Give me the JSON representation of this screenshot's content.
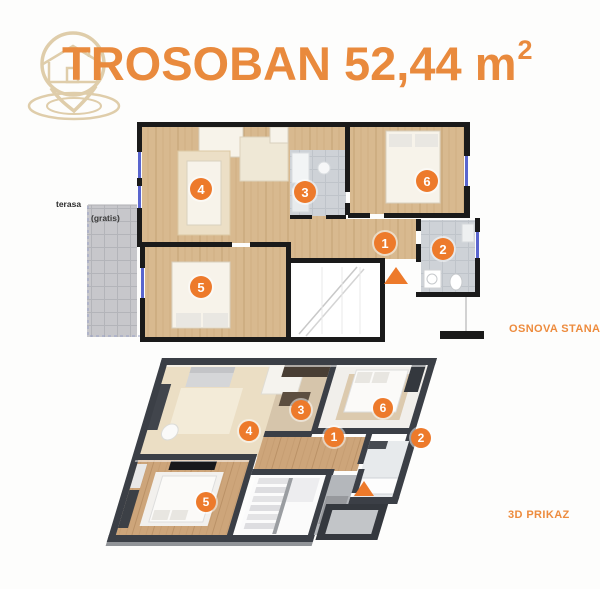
{
  "title": {
    "text": "TROSOBAN 52,44",
    "unit": "m",
    "sup": "2"
  },
  "labels": {
    "plan2d": "OSNOVA STANA",
    "plan3d": "3D PRIKAZ",
    "terrace": "terasa",
    "terrace_note": "(gratis)"
  },
  "badges": [
    {
      "view": "2d",
      "n": "4",
      "x": 201,
      "y": 189,
      "r": 11
    },
    {
      "view": "2d",
      "n": "3",
      "x": 305,
      "y": 192,
      "r": 11
    },
    {
      "view": "2d",
      "n": "6",
      "x": 427,
      "y": 181,
      "r": 11
    },
    {
      "view": "2d",
      "n": "1",
      "x": 385,
      "y": 243,
      "r": 11
    },
    {
      "view": "2d",
      "n": "2",
      "x": 443,
      "y": 249,
      "r": 11
    },
    {
      "view": "2d",
      "n": "5",
      "x": 201,
      "y": 287,
      "r": 11
    },
    {
      "view": "3d",
      "n": "4",
      "x": 249,
      "y": 431,
      "r": 10
    },
    {
      "view": "3d",
      "n": "3",
      "x": 301,
      "y": 410,
      "r": 10
    },
    {
      "view": "3d",
      "n": "6",
      "x": 383,
      "y": 408,
      "r": 10
    },
    {
      "view": "3d",
      "n": "1",
      "x": 334,
      "y": 437,
      "r": 10
    },
    {
      "view": "3d",
      "n": "2",
      "x": 421,
      "y": 438,
      "r": 10
    },
    {
      "view": "3d",
      "n": "5",
      "x": 206,
      "y": 502,
      "r": 10
    }
  ],
  "markers": [
    {
      "view": "2d",
      "x": 396,
      "y": 267,
      "w": 24,
      "h": 17
    },
    {
      "view": "3d",
      "x": 364,
      "y": 481,
      "w": 21,
      "h": 15
    }
  ],
  "colors": {
    "accent": "#e98a3d",
    "badge": "#ed7a2b",
    "badge_text": "#ffffff",
    "wall_2d": "#1a1a1a",
    "wall_3d": "#3b3f46",
    "window": "#4754c9",
    "watermark": "#dcc8a2",
    "background": "#fdfdfc",
    "label": "#ed8b3d",
    "wood_floor": "#d8b98f",
    "tile_floor": "#ced2d7",
    "terrace_floor": "#c7c7cb"
  }
}
